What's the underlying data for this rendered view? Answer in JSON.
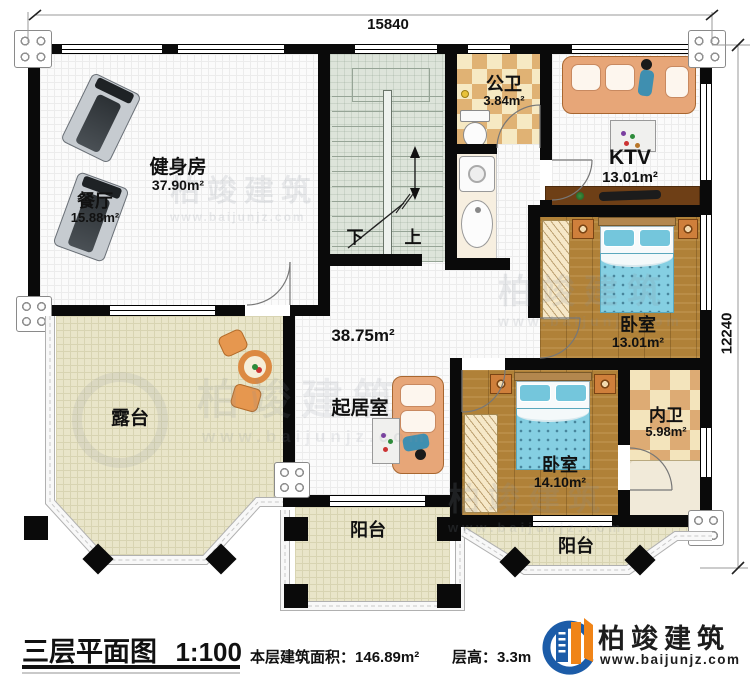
{
  "dims": {
    "top": "15840",
    "right": "12240"
  },
  "rooms": {
    "gym": {
      "name": "健身房",
      "area": "37.90m²"
    },
    "dining": {
      "name": "餐厅",
      "area": "15.88m²"
    },
    "public_bath": {
      "name": "公卫",
      "area": "3.84m²"
    },
    "ktv": {
      "name": "KTV",
      "area": "13.01m²"
    },
    "bedroom1": {
      "name": "卧室",
      "area": "13.01m²"
    },
    "bedroom2": {
      "name": "卧室",
      "area": "14.10m²"
    },
    "ensuite_bath": {
      "name": "内卫",
      "area": "5.98m²"
    },
    "living": {
      "name": "起居室",
      "area": "38.75m²"
    },
    "terrace": {
      "name": "露台"
    },
    "balcony_center": {
      "name": "阳台"
    },
    "balcony_right": {
      "name": "阳台"
    }
  },
  "stairs": {
    "down_label": "下",
    "up_label": "上"
  },
  "titleblock": {
    "title": "三层平面图",
    "scale": "1:100",
    "area_label": "本层建筑面积：",
    "area_value": "146.89m²",
    "height_label": "层高：",
    "height_value": "3.3m"
  },
  "brand": {
    "name": "柏竣建筑",
    "url": "www.baijunjz.com"
  },
  "watermark": {
    "name": "柏竣建筑",
    "url": "www.baijunjz.com"
  },
  "colors": {
    "wall": "#0a0a0a",
    "wood": "#b08138",
    "checker_tan": "#e0b274",
    "terrace": "#e9e5c9",
    "brand_blue": "#1c5ca8",
    "brand_orange": "#f08418"
  }
}
